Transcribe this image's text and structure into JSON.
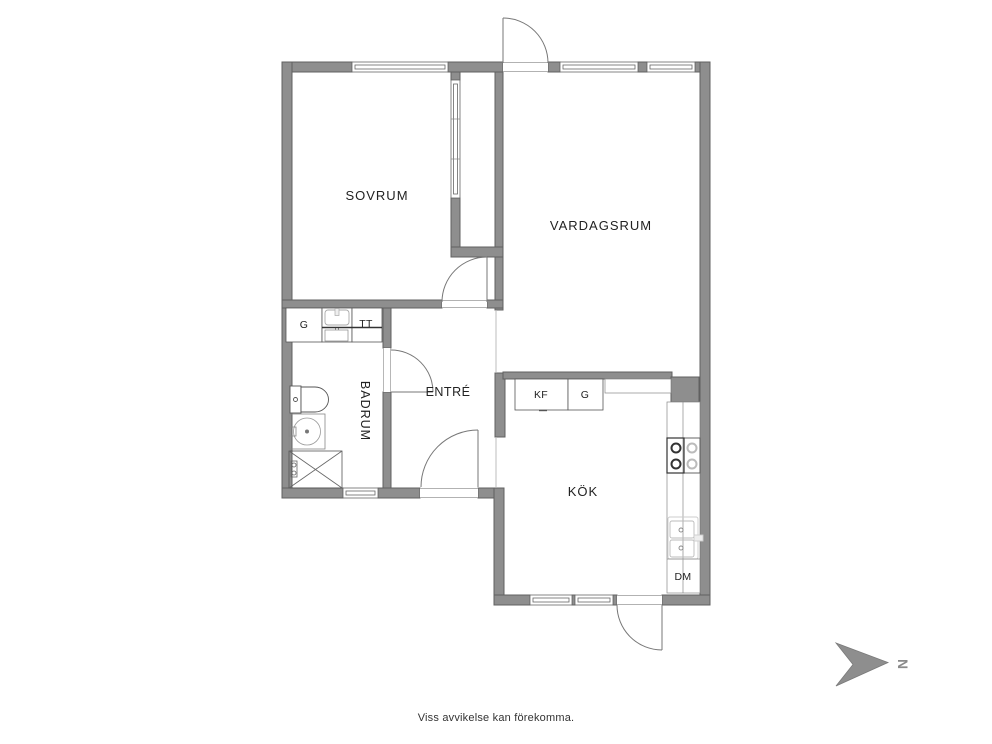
{
  "floorplan": {
    "rooms": {
      "bedroom": "SOVRUM",
      "living_room": "VARDAGSRUM",
      "bathroom": "BADRUM",
      "entrance": "ENTRÉ",
      "kitchen": "KÖK"
    },
    "fixtures": {
      "bathroom_wardrobe": "G",
      "dryer": "TT",
      "fridge_freezer": "KF",
      "kitchen_wardrobe": "G",
      "dishwasher": "DM"
    },
    "compass": {
      "north": "N"
    },
    "footer": {
      "disclaimer": "Viss avvikelse kan förekomma."
    },
    "colors": {
      "wall": "#8e8e8e",
      "wall_edge": "#606060",
      "text": "#222222",
      "arrow": "#8a8a8a"
    }
  }
}
